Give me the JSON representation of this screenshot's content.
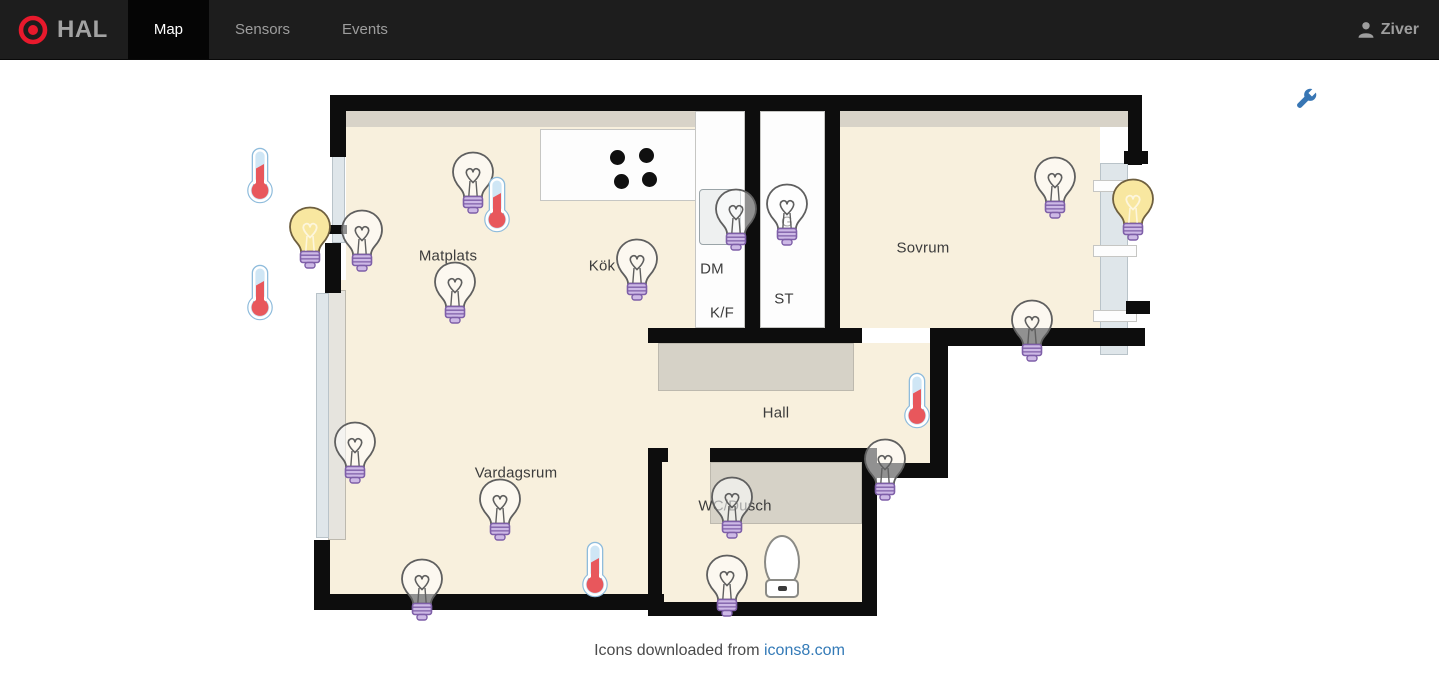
{
  "navbar": {
    "brand": "HAL",
    "tabs": [
      {
        "label": "Map",
        "active": true
      },
      {
        "label": "Sensors",
        "active": false
      },
      {
        "label": "Events",
        "active": false
      }
    ],
    "user": "Ziver"
  },
  "toolbar": {
    "settings_icon": "wrench-icon"
  },
  "map": {
    "rooms": [
      {
        "name": "Matplats",
        "x": 208,
        "y": 171
      },
      {
        "name": "Kök",
        "x": 362,
        "y": 181
      },
      {
        "name": "DM",
        "x": 472,
        "y": 184
      },
      {
        "name": "K/F",
        "x": 482,
        "y": 228
      },
      {
        "name": "ST",
        "x": 544,
        "y": 214
      },
      {
        "name": "G",
        "x": 547,
        "y": 137
      },
      {
        "name": "Sovrum",
        "x": 683,
        "y": 163
      },
      {
        "name": "Hall",
        "x": 536,
        "y": 328
      },
      {
        "name": "Vardagsrum",
        "x": 276,
        "y": 388
      },
      {
        "name": "WC/Dusch",
        "x": 495,
        "y": 421
      }
    ],
    "devices": [
      {
        "type": "light",
        "state": "off",
        "x": 233,
        "y": 100
      },
      {
        "type": "light",
        "state": "off",
        "x": 122,
        "y": 158
      },
      {
        "type": "light",
        "state": "off",
        "x": 215,
        "y": 210
      },
      {
        "type": "light",
        "state": "off",
        "x": 397,
        "y": 187
      },
      {
        "type": "light",
        "state": "off",
        "x": 496,
        "y": 137
      },
      {
        "type": "light",
        "state": "off",
        "x": 547,
        "y": 132
      },
      {
        "type": "light",
        "state": "off",
        "x": 815,
        "y": 105
      },
      {
        "type": "light",
        "state": "off",
        "x": 792,
        "y": 248
      },
      {
        "type": "light",
        "state": "off",
        "x": 645,
        "y": 387
      },
      {
        "type": "light",
        "state": "off",
        "x": 115,
        "y": 370
      },
      {
        "type": "light",
        "state": "off",
        "x": 260,
        "y": 427
      },
      {
        "type": "light",
        "state": "off",
        "x": 182,
        "y": 507
      },
      {
        "type": "light",
        "state": "off",
        "x": 492,
        "y": 425
      },
      {
        "type": "light",
        "state": "off",
        "x": 487,
        "y": 503
      },
      {
        "type": "light",
        "state": "on",
        "x": 70,
        "y": 155
      },
      {
        "type": "light",
        "state": "on",
        "x": 893,
        "y": 127
      },
      {
        "type": "thermometer",
        "x": 20,
        "y": 93
      },
      {
        "type": "thermometer",
        "x": 20,
        "y": 210
      },
      {
        "type": "thermometer",
        "x": 257,
        "y": 122
      },
      {
        "type": "thermometer",
        "x": 677,
        "y": 318
      },
      {
        "type": "thermometer",
        "x": 355,
        "y": 487
      }
    ]
  },
  "footer": {
    "text": "Icons downloaded from",
    "link_text": "icons8.com"
  },
  "colors": {
    "navbar_bg": "#1d1d1d",
    "active_tab_bg": "#050505",
    "navbar_text": "#9d9d9d",
    "brand_red": "#e8192c",
    "wrench_blue": "#3876b4",
    "link_blue": "#337ab7",
    "bulb_on_yellow": "#f8e7a0",
    "bulb_base_purple": "#cdb9e6",
    "thermometer_red": "#e8575c",
    "thermometer_tube": "#cfe6f5",
    "floor_beige": "#f8f0dd",
    "wall_black": "#0d0d0d"
  }
}
